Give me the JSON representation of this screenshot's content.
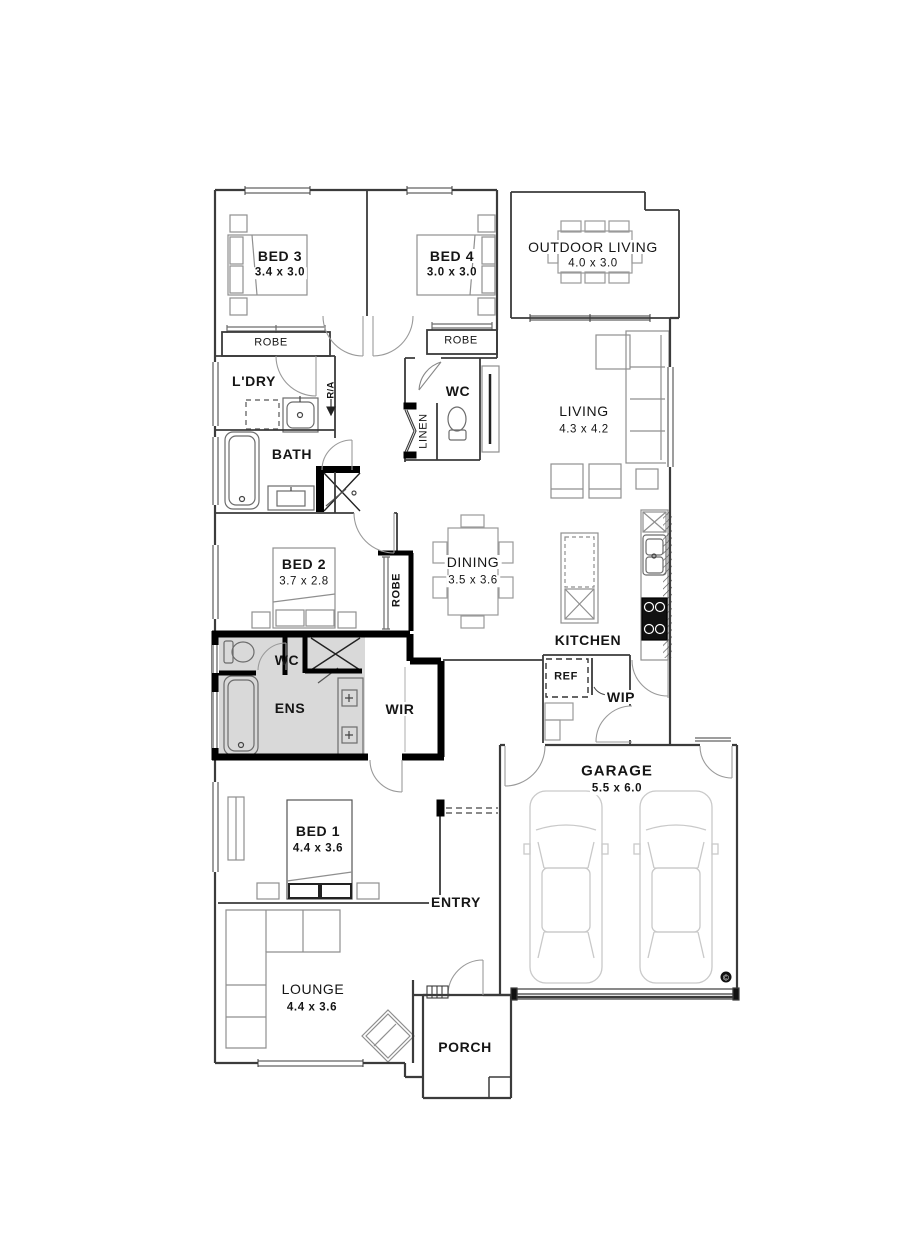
{
  "rooms": {
    "bed3": {
      "label": "BED 3",
      "dims": "3.4 x 3.0"
    },
    "bed4": {
      "label": "BED 4",
      "dims": "3.0 x 3.0"
    },
    "outdoor_living": {
      "label": "OUTDOOR LIVING",
      "dims": "4.0 x 3.0"
    },
    "living": {
      "label": "LIVING",
      "dims": "4.3 x 4.2"
    },
    "dining": {
      "label": "DINING",
      "dims": "3.5 x 3.6"
    },
    "kitchen": {
      "label": "KITCHEN"
    },
    "bed2": {
      "label": "BED 2",
      "dims": "3.7 x 2.8"
    },
    "bed1": {
      "label": "BED 1",
      "dims": "4.4 x 3.6"
    },
    "lounge": {
      "label": "LOUNGE",
      "dims": "4.4 x 3.6"
    },
    "garage": {
      "label": "GARAGE",
      "dims": "5.5 x 6.0"
    },
    "ldry": {
      "label": "L'DRY"
    },
    "bath": {
      "label": "BATH"
    },
    "wc_main": {
      "label": "WC"
    },
    "wc_ens": {
      "label": "WC"
    },
    "ens": {
      "label": "ENS"
    },
    "wir": {
      "label": "WIR"
    },
    "wip": {
      "label": "WIP"
    },
    "entry": {
      "label": "ENTRY"
    },
    "porch": {
      "label": "PORCH"
    },
    "robe_bed3": {
      "label": "ROBE"
    },
    "robe_bed4": {
      "label": "ROBE"
    },
    "robe_bed2": {
      "label": "ROBE"
    },
    "linen": {
      "label": "LINEN"
    },
    "ref": {
      "label": "REF"
    },
    "return_air": {
      "label": "R/A"
    }
  },
  "marks": {
    "garage_symbol": "©"
  },
  "colors": {
    "wall": "#3b3b3b",
    "thick_wall": "#000000",
    "wet_area_fill": "#d9d9d9",
    "furniture": "#8f8f8f",
    "car": "#c9c9c9"
  }
}
